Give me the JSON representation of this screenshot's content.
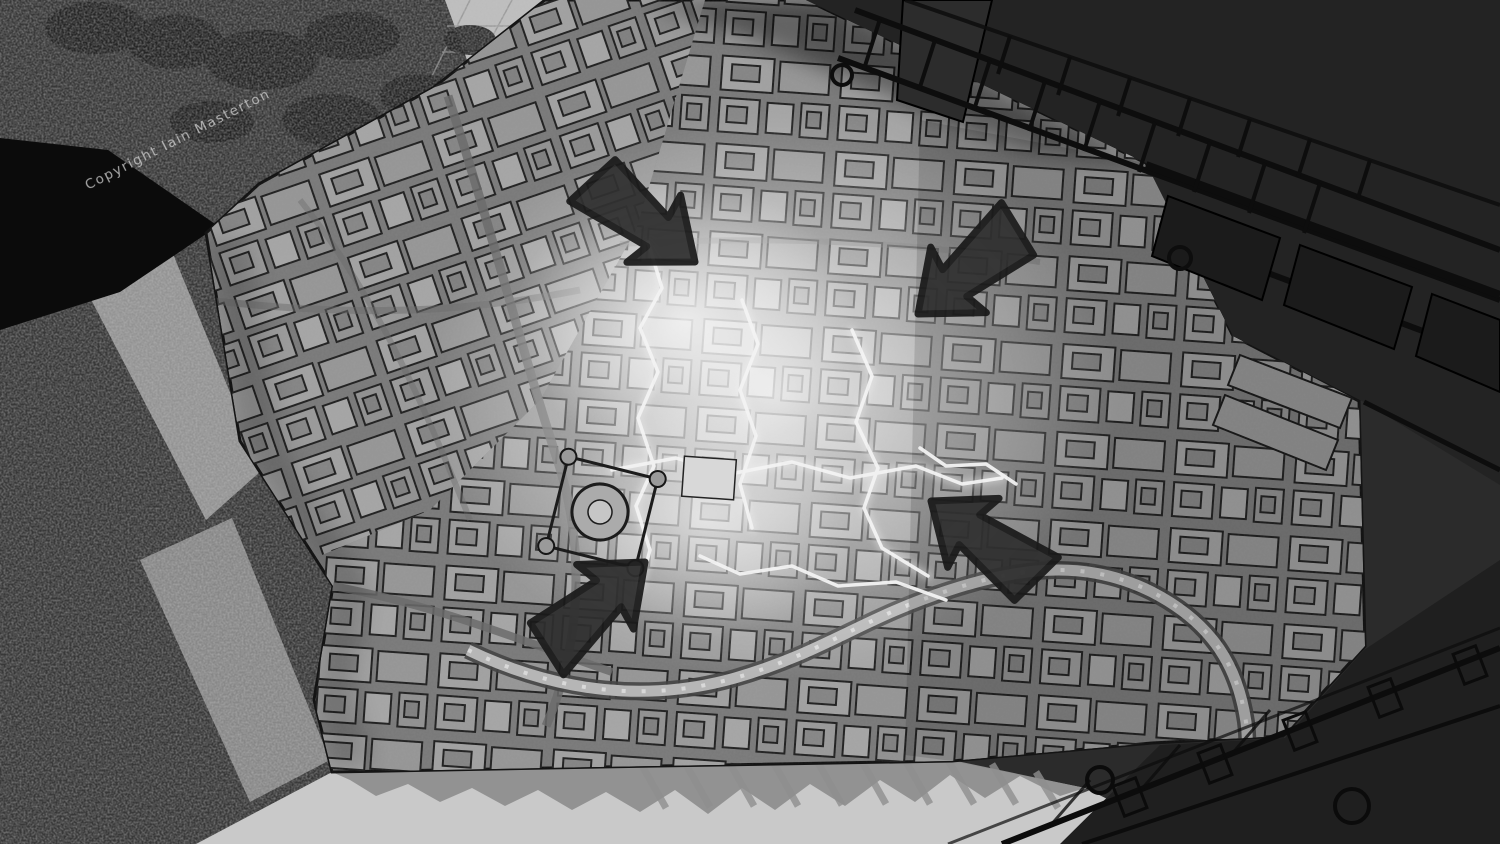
{
  "scene": {
    "description": "Monochrome concept painting: top-down view of a detailed city model with a glowing damaged centre, forest gorge to the west, dark overhead girder structures across the corners, and four hand-drawn annotation arrows",
    "watermark": {
      "text": "Copyright Iain Masterton"
    },
    "palette": {
      "bg": "#2b2b2b",
      "beam": "#232323",
      "beam-low": "#1f1f1f",
      "girder-line": "#0d0d0d",
      "outline": "#1a1a1a",
      "street": "#7a7a7a",
      "building": "#9e9e9e",
      "floor": "#c9c9c9",
      "shadow": "#8f8f8f",
      "forest": "#373737",
      "cliff": "#a3a3a3",
      "canopy": "#242424",
      "plaza": "#bdbdbd",
      "river": "#b6b6b6",
      "crack": "#f3f3f3",
      "arrow": "#2f2f2f",
      "watermark": "#d4d4d4",
      "wedge": "#0b0b0b"
    },
    "arrows": [
      {
        "name": "annotation-arrow-north",
        "direction": "down-right",
        "x": 695,
        "y": 262,
        "angle": 40
      },
      {
        "name": "annotation-arrow-northeast",
        "direction": "down-left",
        "x": 918,
        "y": 314,
        "angle": 141
      },
      {
        "name": "annotation-arrow-east",
        "direction": "up-left",
        "x": 931,
        "y": 501,
        "angle": 218
      },
      {
        "name": "annotation-arrow-south",
        "direction": "up-right",
        "x": 645,
        "y": 562,
        "angle": -40
      }
    ]
  }
}
